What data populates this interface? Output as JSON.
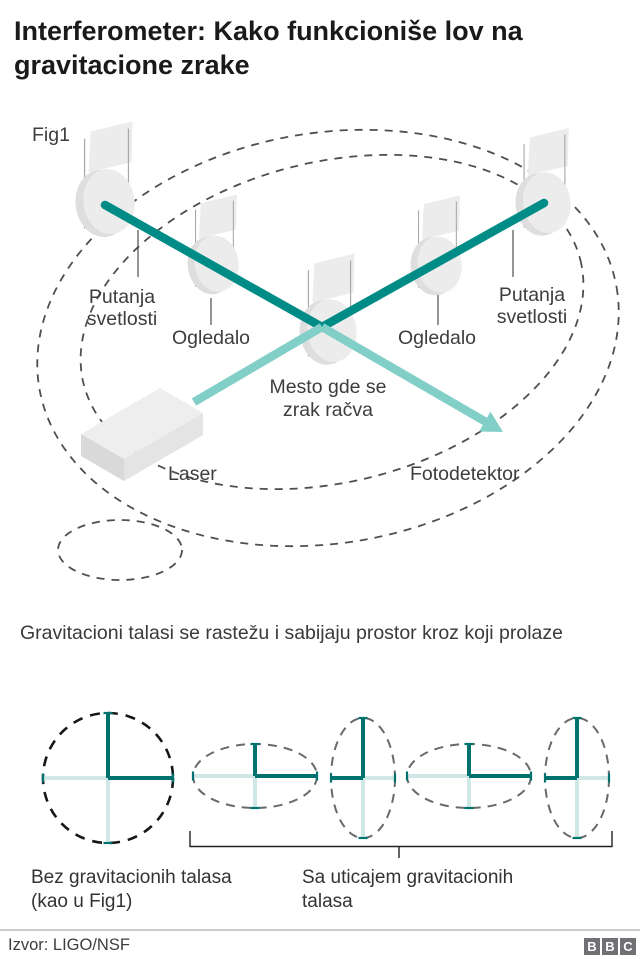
{
  "header": {
    "title": "Interferometer: Kako funkcioniše lov na gravitacione zrake"
  },
  "fig1": {
    "label": "Fig1"
  },
  "interferometer": {
    "light_path_left": {
      "line1": "Putanja",
      "line2": "svetlosti"
    },
    "mirror_left_label": "Ogledalo",
    "mirror_right_label": "Ogledalo",
    "light_path_right": {
      "line1": "Putanja",
      "line2": "svetlosti"
    },
    "splitter_label": {
      "line1": "Mesto gde se",
      "line2": "zrak račva"
    },
    "laser_label": "Laser",
    "photodetector_label": "Fotodetektor"
  },
  "caption": {
    "text": "Gravitacioni talasi se rastežu i sabijaju prostor kroz koji prolaze"
  },
  "wave_demo": {
    "without_label_line1": "Bez gravitacionih talasa",
    "without_label_line2": "(kao u Fig1)",
    "with_label_line1": "Sa uticajem gravitacionih",
    "with_label_line2": "talasa"
  },
  "footer": {
    "source": "Izvor: LIGO/NSF",
    "logo_letters": [
      "B",
      "B",
      "C"
    ]
  },
  "colors": {
    "beam_dark_teal": "#008c86",
    "beam_light_teal": "#82cfc8",
    "cross_dark_teal": "#00736f",
    "cross_pale_teal": "#cfe8e6",
    "mirror_gray": "#ececec",
    "dash_gray": "#4f4f4f",
    "title_text": "#1a1a1a",
    "logo_gray": "#717175"
  }
}
